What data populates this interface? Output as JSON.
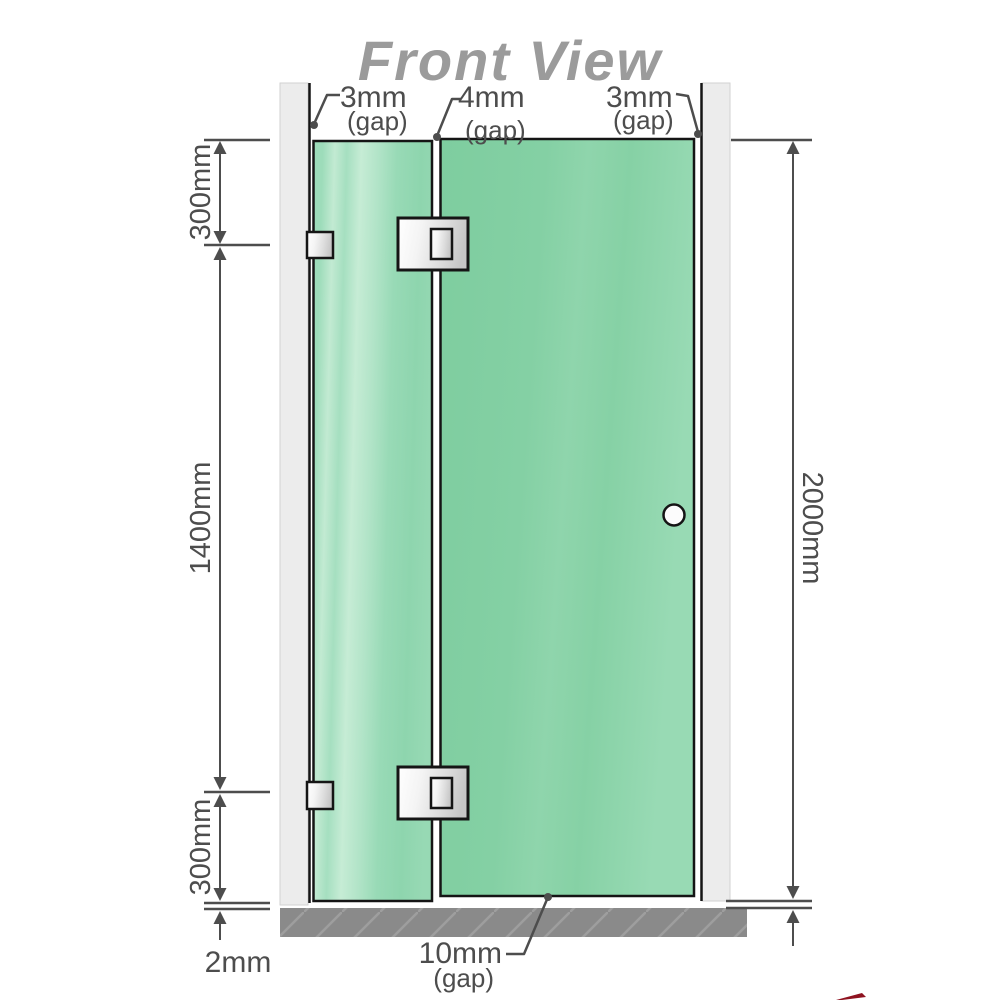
{
  "title": "Front View",
  "diagram": {
    "top_gaps": [
      {
        "value": "3mm",
        "suffix": "(gap)"
      },
      {
        "value": "4mm",
        "suffix": "(gap)"
      },
      {
        "value": "3mm",
        "suffix": "(gap)"
      }
    ],
    "left_dims": {
      "top": "300mm",
      "middle": "1400mm",
      "bottom": "300mm",
      "floor_gap": "2mm"
    },
    "right_dims": {
      "total_height": "2000mm"
    },
    "bottom_gap": {
      "value": "10mm",
      "suffix": "(gap)"
    }
  },
  "colors": {
    "glass_green": "#8ad2a7",
    "glass_green_light": "#c6ebd5",
    "wall_gray": "#ececec",
    "floor_gray": "#8a8a8a",
    "outline_black": "#151515",
    "dimension_gray": "#4d4d4d",
    "title_gray": "#9b9b9b",
    "accent_red": "#8f1320"
  }
}
